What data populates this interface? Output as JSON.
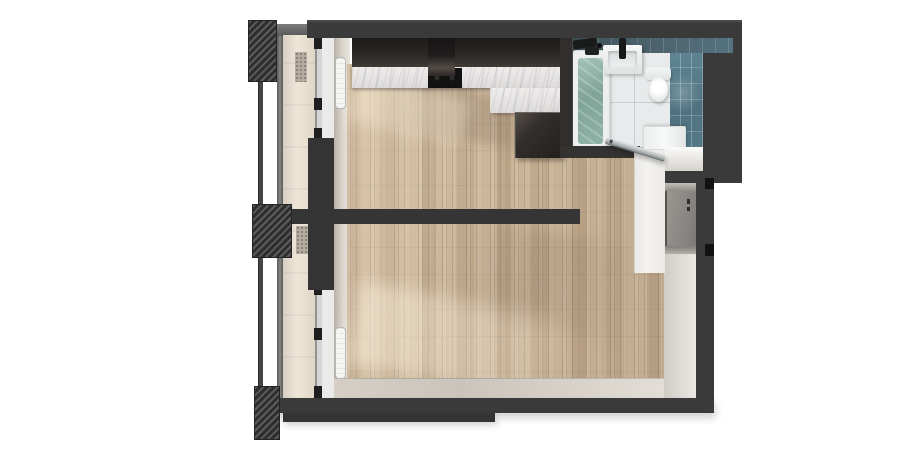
{
  "scene": {
    "kind": "3d-floor-plan-top-down-render",
    "description": "Photoreal top view of a studio apartment: kitchen-living room and sleeping area with wood plank flooring, teal-tiled bathroom top right, entry niche on right wall, full-height glazing with balcony and hatched privacy dividers on the left",
    "background": "#ffffff"
  },
  "palette": {
    "bg": "#ffffff",
    "wall": "#3a3a3a",
    "wood": "#c9b296",
    "marble": "#efedeb",
    "cabinet": "#292624",
    "tileTeal": "#4f7180",
    "tileTealDark": "#43575f",
    "bathFloor": "#e8eaeb",
    "water": "#7fa396",
    "fixture": "#edefee",
    "hall": "#f4f3f1",
    "doorPanel": "#868380",
    "doorFrame": "#57534e",
    "face": "#ddd8d1",
    "balconyFloor": "#efe6d8",
    "railing": "#454545",
    "radiator": "#f5f5f3",
    "silver": "#a9aeb0",
    "glassTint": "rgba(140,143,135,0.18)"
  },
  "inventory": {
    "rooms": [
      "kitchen-living-room",
      "sleeping-living-area",
      "bathroom",
      "entry-hall",
      "balcony"
    ],
    "kitchen_fixtures": [
      "upper-cabinets",
      "range-hood",
      "cooktop",
      "marble-countertop",
      "counter-return",
      "tall-cabinet"
    ],
    "bathroom_fixtures": [
      "bathtub",
      "tub-faucet",
      "washbasin",
      "basin-faucet",
      "toilet",
      "washing-machine",
      "teal-wall-tiles",
      "open-glass-door"
    ],
    "entry_fixtures": [
      "entrance-door",
      "door-niche",
      "hall-closet"
    ],
    "window_wall": [
      "floor-to-ceiling-glazing",
      "radiator-upper",
      "radiator-lower",
      "balcony-railing",
      "balcony-privacy-dividers"
    ]
  }
}
